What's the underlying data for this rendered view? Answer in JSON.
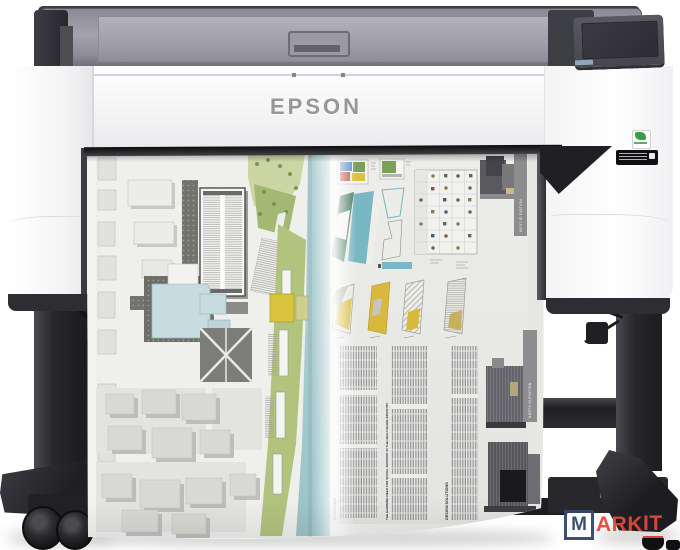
{
  "scene": {
    "description": "Product photo of an Epson large-format inkjet printer on a floor stand, printing a wide architectural poster",
    "background_color": "#ffffff"
  },
  "printer": {
    "brand_logo": "EPSON",
    "accent_colors": {
      "cover_smoke": "#9d9ca8",
      "body_white": "#f4f4f5",
      "stand_black": "#26262b",
      "eco_label_green": "#3e9b46"
    }
  },
  "poster": {
    "left_panel": "city site-plan map",
    "right_panel": "architectural report page with diagrams, icon table and text columns",
    "headings": {
      "overview": "OVERVIEW",
      "growing_need": "THE GROWING NEED FOR SOCIAL SUPPORT IN THE HEALTHCARE INDUSTRY",
      "design_solutions": "DESIGN SOLUTIONS"
    },
    "elevation_labels": {
      "west": "WEST ELEVATION",
      "north": "NORTH ELEVATION"
    },
    "palette": {
      "water_teal": "#a9cdd2",
      "park_green": "#a8bd72",
      "accent_yellow": "#d9b93c",
      "diagram_teal": "#79b7c2",
      "diagram_dark_green": "#4f7d62",
      "building_gray": "#d6d6d3"
    }
  },
  "watermark": {
    "boxed_letter": "M",
    "text_plain": "ARK",
    "text_underlined": "IT",
    "box_color": "#34476b",
    "text_color": "#e2483d"
  }
}
